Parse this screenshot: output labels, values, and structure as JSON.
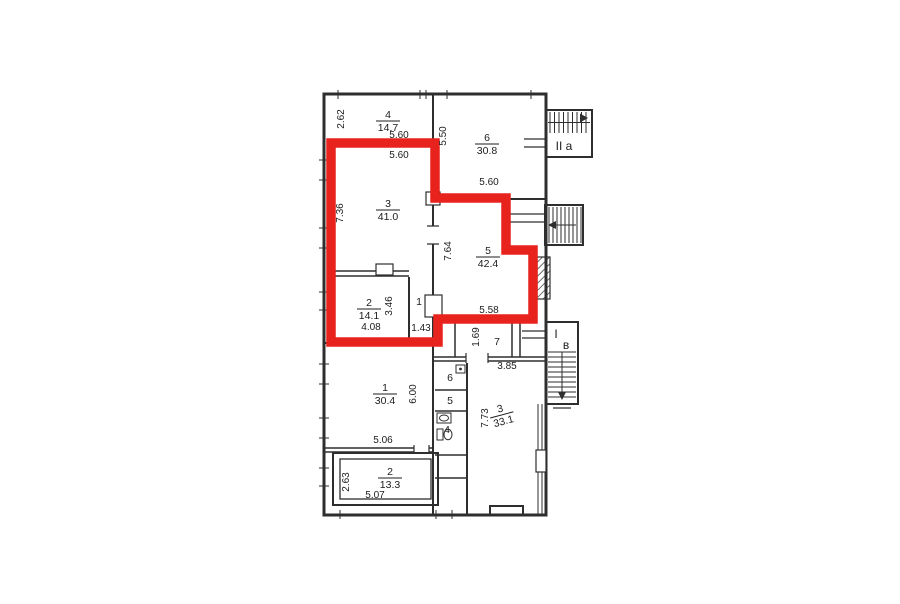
{
  "plan": {
    "highlight_color": "#e8231d",
    "wall_color": "#2e2e2e",
    "rooms": [
      {
        "n": "4",
        "a": "14.7",
        "x": 388,
        "y": 118
      },
      {
        "n": "6",
        "a": "30.8",
        "x": 487,
        "y": 141
      },
      {
        "n": "3",
        "a": "41.0",
        "x": 388,
        "y": 207
      },
      {
        "n": "5",
        "a": "42.4",
        "x": 488,
        "y": 254
      },
      {
        "n": "2",
        "a": "14.1",
        "x": 369,
        "y": 306
      },
      {
        "n": "1",
        "x": 419,
        "y": 305
      },
      {
        "n": "7",
        "x": 497,
        "y": 345
      },
      {
        "n": "1",
        "a": "30.4",
        "x": 385,
        "y": 391
      },
      {
        "n": "6",
        "x": 450,
        "y": 381
      },
      {
        "n": "5",
        "x": 450,
        "y": 404
      },
      {
        "n": "4",
        "x": 447,
        "y": 433
      },
      {
        "n": "3",
        "a": "33.1",
        "x": 501,
        "y": 412,
        "r": -15
      },
      {
        "n": "2",
        "a": "13.3",
        "x": 390,
        "y": 475
      }
    ],
    "dims": [
      {
        "t": "2.62",
        "x": 344,
        "y": 119,
        "r": -90
      },
      {
        "t": "5.60",
        "x": 399,
        "y": 138
      },
      {
        "t": "5.50",
        "x": 446,
        "y": 136,
        "r": -90
      },
      {
        "t": "5.60",
        "x": 399,
        "y": 158
      },
      {
        "t": "5.60",
        "x": 489,
        "y": 185
      },
      {
        "t": "7.36",
        "x": 343,
        "y": 213,
        "r": -90
      },
      {
        "t": "7.64",
        "x": 451,
        "y": 251,
        "r": -90
      },
      {
        "t": "3.46",
        "x": 392,
        "y": 306,
        "r": -90
      },
      {
        "t": "4.08",
        "x": 371,
        "y": 330
      },
      {
        "t": "1.43",
        "x": 421,
        "y": 331
      },
      {
        "t": "5.58",
        "x": 489,
        "y": 313
      },
      {
        "t": "1.69",
        "x": 479,
        "y": 337,
        "r": -90
      },
      {
        "t": "3.85",
        "x": 507,
        "y": 369
      },
      {
        "t": "6.00",
        "x": 416,
        "y": 394,
        "r": -90
      },
      {
        "t": "5.06",
        "x": 383,
        "y": 443
      },
      {
        "t": "7.73",
        "x": 488,
        "y": 418,
        "r": -90
      },
      {
        "t": "2.63",
        "x": 349,
        "y": 482,
        "r": -90
      },
      {
        "t": "5.07",
        "x": 375,
        "y": 498
      }
    ],
    "stairs": [
      {
        "t": "II a",
        "x": 564,
        "y": 150
      },
      {
        "t": "I",
        "x": 556,
        "y": 338
      },
      {
        "t": "в",
        "x": 566,
        "y": 349
      }
    ],
    "icons": {
      "toilet": "toilet-icon",
      "sink": "sink-icon",
      "stove": "stove-icon",
      "stair_arrow": "stair-direction-arrow"
    }
  }
}
